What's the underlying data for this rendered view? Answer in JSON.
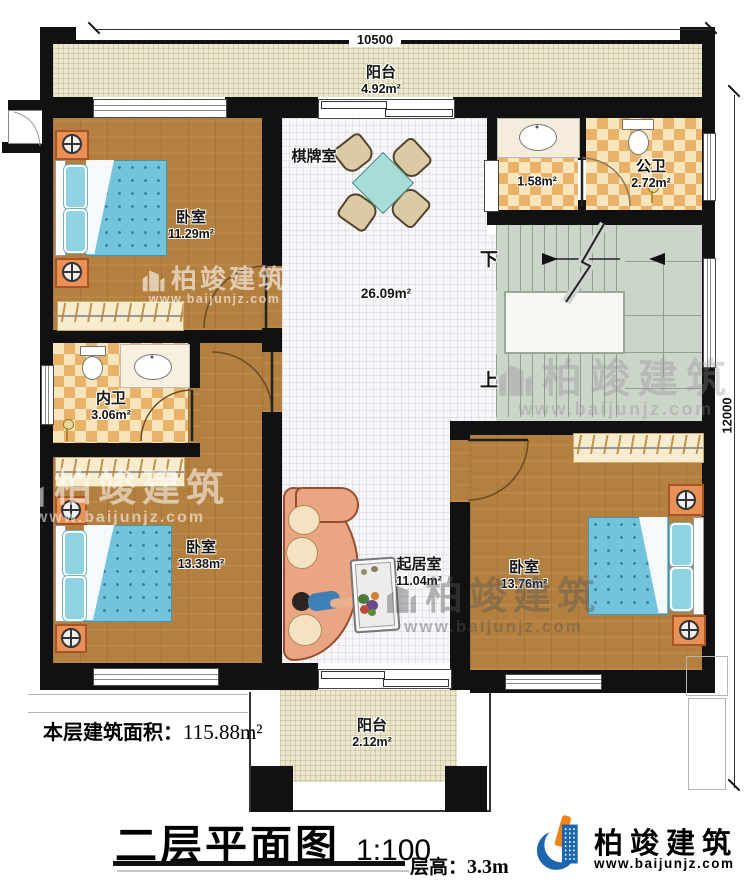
{
  "dims": {
    "width": "10500",
    "height": "12000"
  },
  "rooms": {
    "balcony_top": {
      "name": "阳台",
      "area": "4.92m²"
    },
    "chess": {
      "name": "棋牌室",
      "area": "26.09m²"
    },
    "bedroom_nw": {
      "name": "卧室",
      "area": "11.29m²"
    },
    "bath_vestibule": {
      "area": "1.58m²"
    },
    "public_bath": {
      "name": "公卫",
      "area": "2.72m²"
    },
    "inner_bath": {
      "name": "内卫",
      "area": "3.06m²"
    },
    "bedroom_sw": {
      "name": "卧室",
      "area": "13.38m²"
    },
    "living": {
      "name": "起居室",
      "area": "11.04m²"
    },
    "bedroom_se": {
      "name": "卧室",
      "area": "13.76m²"
    },
    "balcony_bottom": {
      "name": "阳台",
      "area": "2.12m²"
    }
  },
  "stairs": {
    "down": "下",
    "up": "上"
  },
  "titleblock": {
    "area_label": "本层建筑面积：",
    "area_value": "115.88m²",
    "title": "二层平面图",
    "scale": "1:100",
    "floor_height_label": "层高：",
    "floor_height_value": "3.3m"
  },
  "brand": {
    "name": "柏竣建筑",
    "website": "www.baijunjz.com"
  },
  "colors": {
    "wall": "#111111",
    "wood": "#b3803f",
    "tile_dark": "#e9b269",
    "tile_light": "#f8e5bc",
    "stair": "#ccd5ca",
    "balcony": "#ebe7cf",
    "bed_blue": "#72c3dc",
    "accent_blue": "#1b66ad",
    "accent_orange": "#f08419"
  }
}
